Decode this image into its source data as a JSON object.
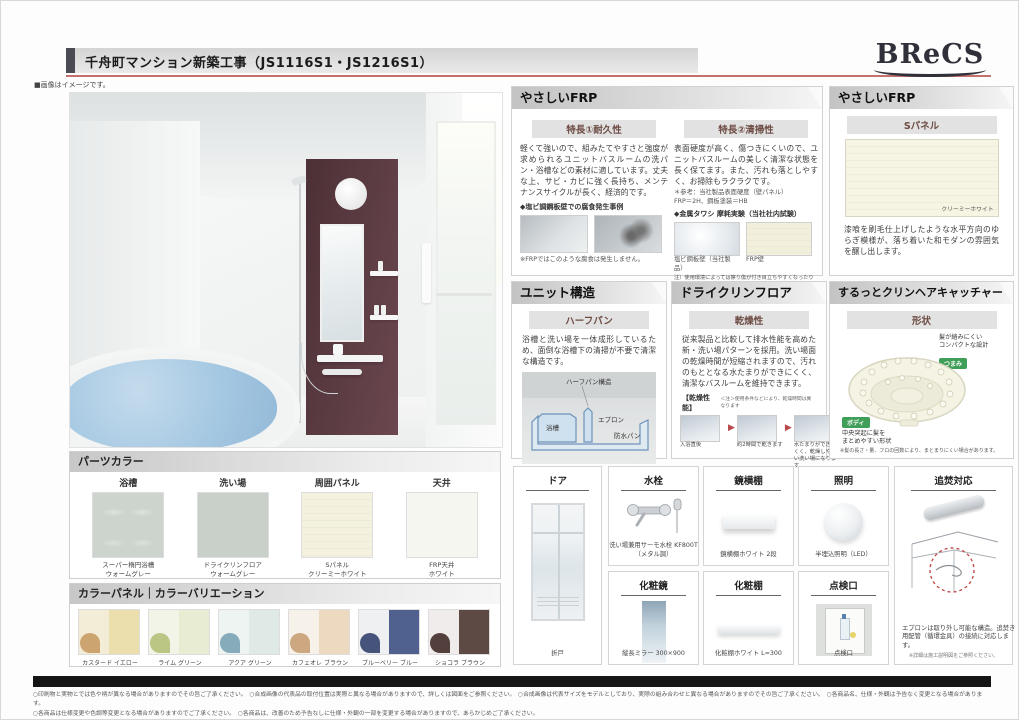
{
  "header": {
    "title": "千舟町マンション新築工事（JS1116S1・JS1216S1）",
    "logo": "BReCS",
    "image_note": "■画像はイメージです。"
  },
  "sections": {
    "frp": {
      "title": "やさしいFRP",
      "features": [
        {
          "heading": "特長①耐久性",
          "body": "軽くて強いので、組みたてやすさと強度が求められるユニットバスルームの洗パン・浴槽などの素材に適しています。丈夫な上、サビ・カビに強く長持ち、メンテナンスサイクルが長く、経済的です。",
          "case_label": "◆塩ビ調鋼板壁での腐食発生事例",
          "case_note": "※FRPではこのような腐食は発生しません。"
        },
        {
          "heading": "特長②清掃性",
          "body": "表面硬度が高く、傷つきにくいので、ユニットバスルームの美しく清潔な状態を長く保てます。また、汚れも落としやすく、お掃除もラクラクです。",
          "ref": "＊参考：当社製品表面硬度（壁パネル）\nFRP＝2H、鋼板塗装＝HB",
          "test_label": "◆金属タワシ 摩耗実験（当社社内試験）",
          "captions": [
            "塩ビ鋼板壁（当社製品）",
            "FRP壁"
          ],
          "note": "注）使用環境によっては擦り傷が付き目立ちやすくなったりする場合があり、金属タワシのご使用を推奨するものではありません。"
        }
      ]
    },
    "spanel": {
      "title": "やさしいFRP",
      "subtitle": "Sパネル",
      "swatch_label": "クリーミーホワイト",
      "body": "漆喰を刷毛仕上げしたような水平方向のゆらぎ模様が、落ち着いた和モダンの雰囲気を醸し出します。"
    },
    "unit": {
      "title": "ユニット構造",
      "subtitle": "ハーフパン",
      "body": "浴槽と洗い場を一体成形しているため、面倒な浴槽下の清掃が不要で清潔な構造です。",
      "diagram_labels": [
        "ハーフパン構造",
        "浴槽",
        "エプロン",
        "防水パン"
      ]
    },
    "dryfloor": {
      "title": "ドライクリンフロア",
      "subtitle": "乾燥性",
      "body": "従来製品と比較して排水性能を高めた新・洗い場パターンを採用。洗い場面の乾燥時間が短縮されますので、汚れのもととなる水たまりができにくく、清潔なバスルームを維持できます。",
      "perf_label": "【乾燥性能】",
      "perf_note": "＜注＞使用条件などにより、乾燥時間は異なります",
      "steps": [
        "入浴直後",
        "約2時間で乾きます",
        "水たまりができにくく、乾燥しやすい洗い場になります"
      ]
    },
    "haircatcher": {
      "title": "するっとクリンヘアキャッチャー",
      "subtitle": "形状",
      "annotation_top": "髪が絡みにくい\nコンパクトな設計",
      "badge_top": "つまみ",
      "badge_bottom": "ボディ",
      "annotation_bottom": "中央突起に髪を\nまとめやすい形状",
      "note": "※髪の長さ・量、フロの回数により、まとまりにくい場合があります。"
    }
  },
  "parts_color": {
    "title": "パーツカラー",
    "items": [
      {
        "label": "浴槽",
        "caption": "スーパー楕円浴槽\nウォームグレー"
      },
      {
        "label": "洗い場",
        "caption": "ドライクリンフロア\nウォームグレー"
      },
      {
        "label": "周囲パネル",
        "caption": "Sパネル\nクリーミーホワイト"
      },
      {
        "label": "天井",
        "caption": "FRP天井\nホワイト"
      }
    ]
  },
  "color_panel": {
    "title": "カラーパネル｜カラーバリエーション",
    "items": [
      {
        "label": "カスタード イエロー"
      },
      {
        "label": "ライム グリーン"
      },
      {
        "label": "アクア グリーン"
      },
      {
        "label": "カフェオレ ブラウン"
      },
      {
        "label": "ブルーベリー ブルー"
      },
      {
        "label": "ショコラ ブラウン"
      }
    ]
  },
  "items": {
    "door": {
      "title": "ドア",
      "caption": "折戸"
    },
    "faucet": {
      "title": "水栓",
      "caption": "洗い場兼用サーモ水栓 KF800T\n（メタル調）"
    },
    "mirror_shelf": {
      "title": "鏡横棚",
      "caption": "鏡横棚ホワイト 2段"
    },
    "light": {
      "title": "照明",
      "caption": "半埋込照明（LED）"
    },
    "reheat": {
      "title": "追焚対応",
      "caption": "エプロンは取り外し可能な構造。追焚き用配管（循環金具）の接続に対応します。",
      "note": "※詳細は施工説明図をご参照ください。"
    },
    "mirror": {
      "title": "化粧鏡",
      "caption": "縦長ミラー 300×900"
    },
    "shelf": {
      "title": "化粧棚",
      "caption": "化粧棚ホワイト L=300"
    },
    "hatch": {
      "title": "点検口",
      "caption": "点検口"
    }
  },
  "footer": {
    "line1": "○印刷物と実物とでは色や柄が異なる場合がありますのでその旨ご了承ください。　○合成画像の代表品の取付位置は実際と異なる場合がありますので、詳しくは図面をご参照ください。　○合成画像は代表サイズをモデルとしており、実際の組み合わせと異なる場合がありますのでその旨ご了承ください。　○各商品名、仕様・外観は予告なく変更となる場合があります。",
    "line2": "○各商品は仕様変更や色調等変更となる場合がありますのでご了承ください。　○各商品は、改善のため予告なしに仕様・外観の一部を変更する場合がありますので、あらかじめご了承ください。"
  },
  "colors": {
    "accent_red": "#c4706c",
    "panel_brown": "#55383e",
    "water_blue": "#a5c8e2",
    "badge_green": "#3f9e58"
  }
}
